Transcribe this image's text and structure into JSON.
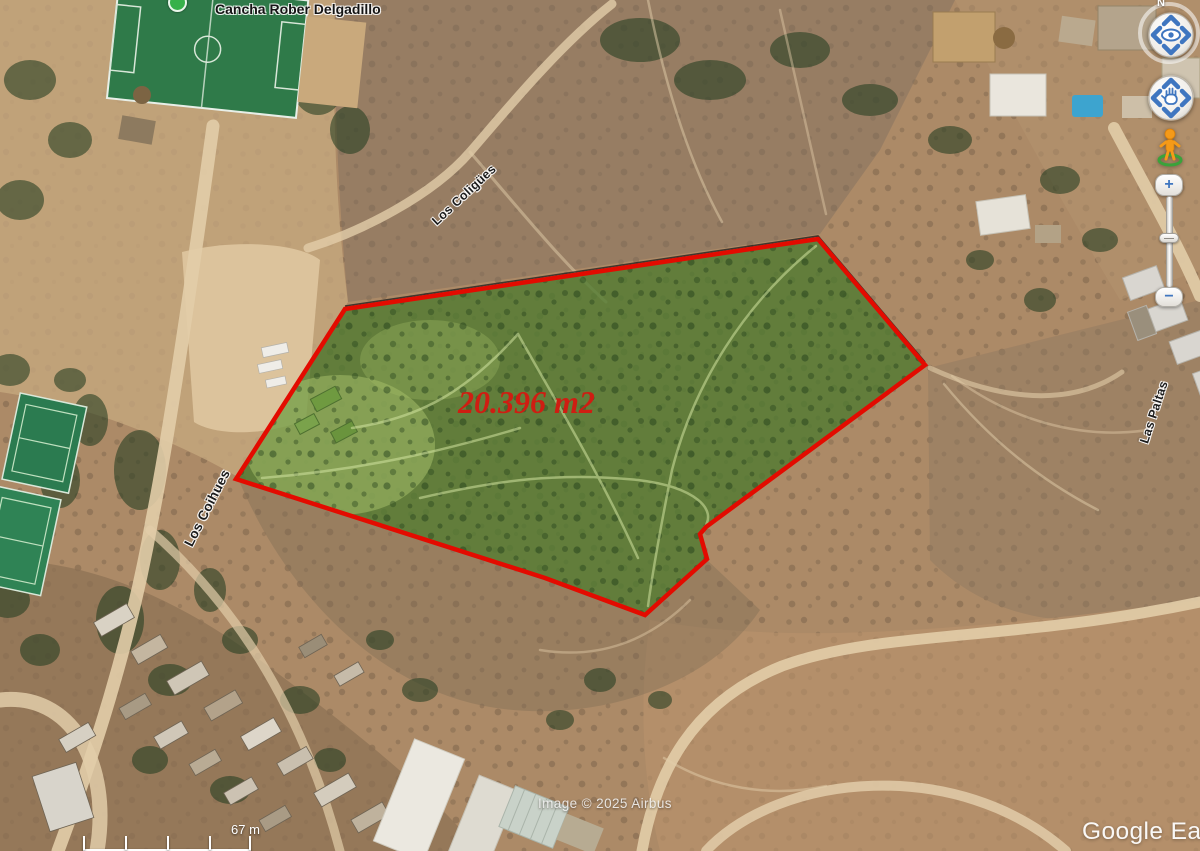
{
  "map": {
    "placemark_label": "Cancha Rober Delgadillo",
    "area_label": "20.396 m2",
    "streets": [
      {
        "name": "Los Coligües"
      },
      {
        "name": "Los Coihues"
      },
      {
        "name": "Las Paltas"
      }
    ],
    "attribution": "Image © 2025 Airbus",
    "scale_label": "67 m",
    "watermark": "Google Earth"
  },
  "controls": {
    "compass_north_label": "N",
    "zoom_in_label": "+",
    "zoom_out_label": "−"
  },
  "colors": {
    "parcel_fill": "#4d7a2f",
    "parcel_outline": "#e30b00",
    "area_label_color": "#cf1d12",
    "control_accent": "#3f76c0"
  }
}
